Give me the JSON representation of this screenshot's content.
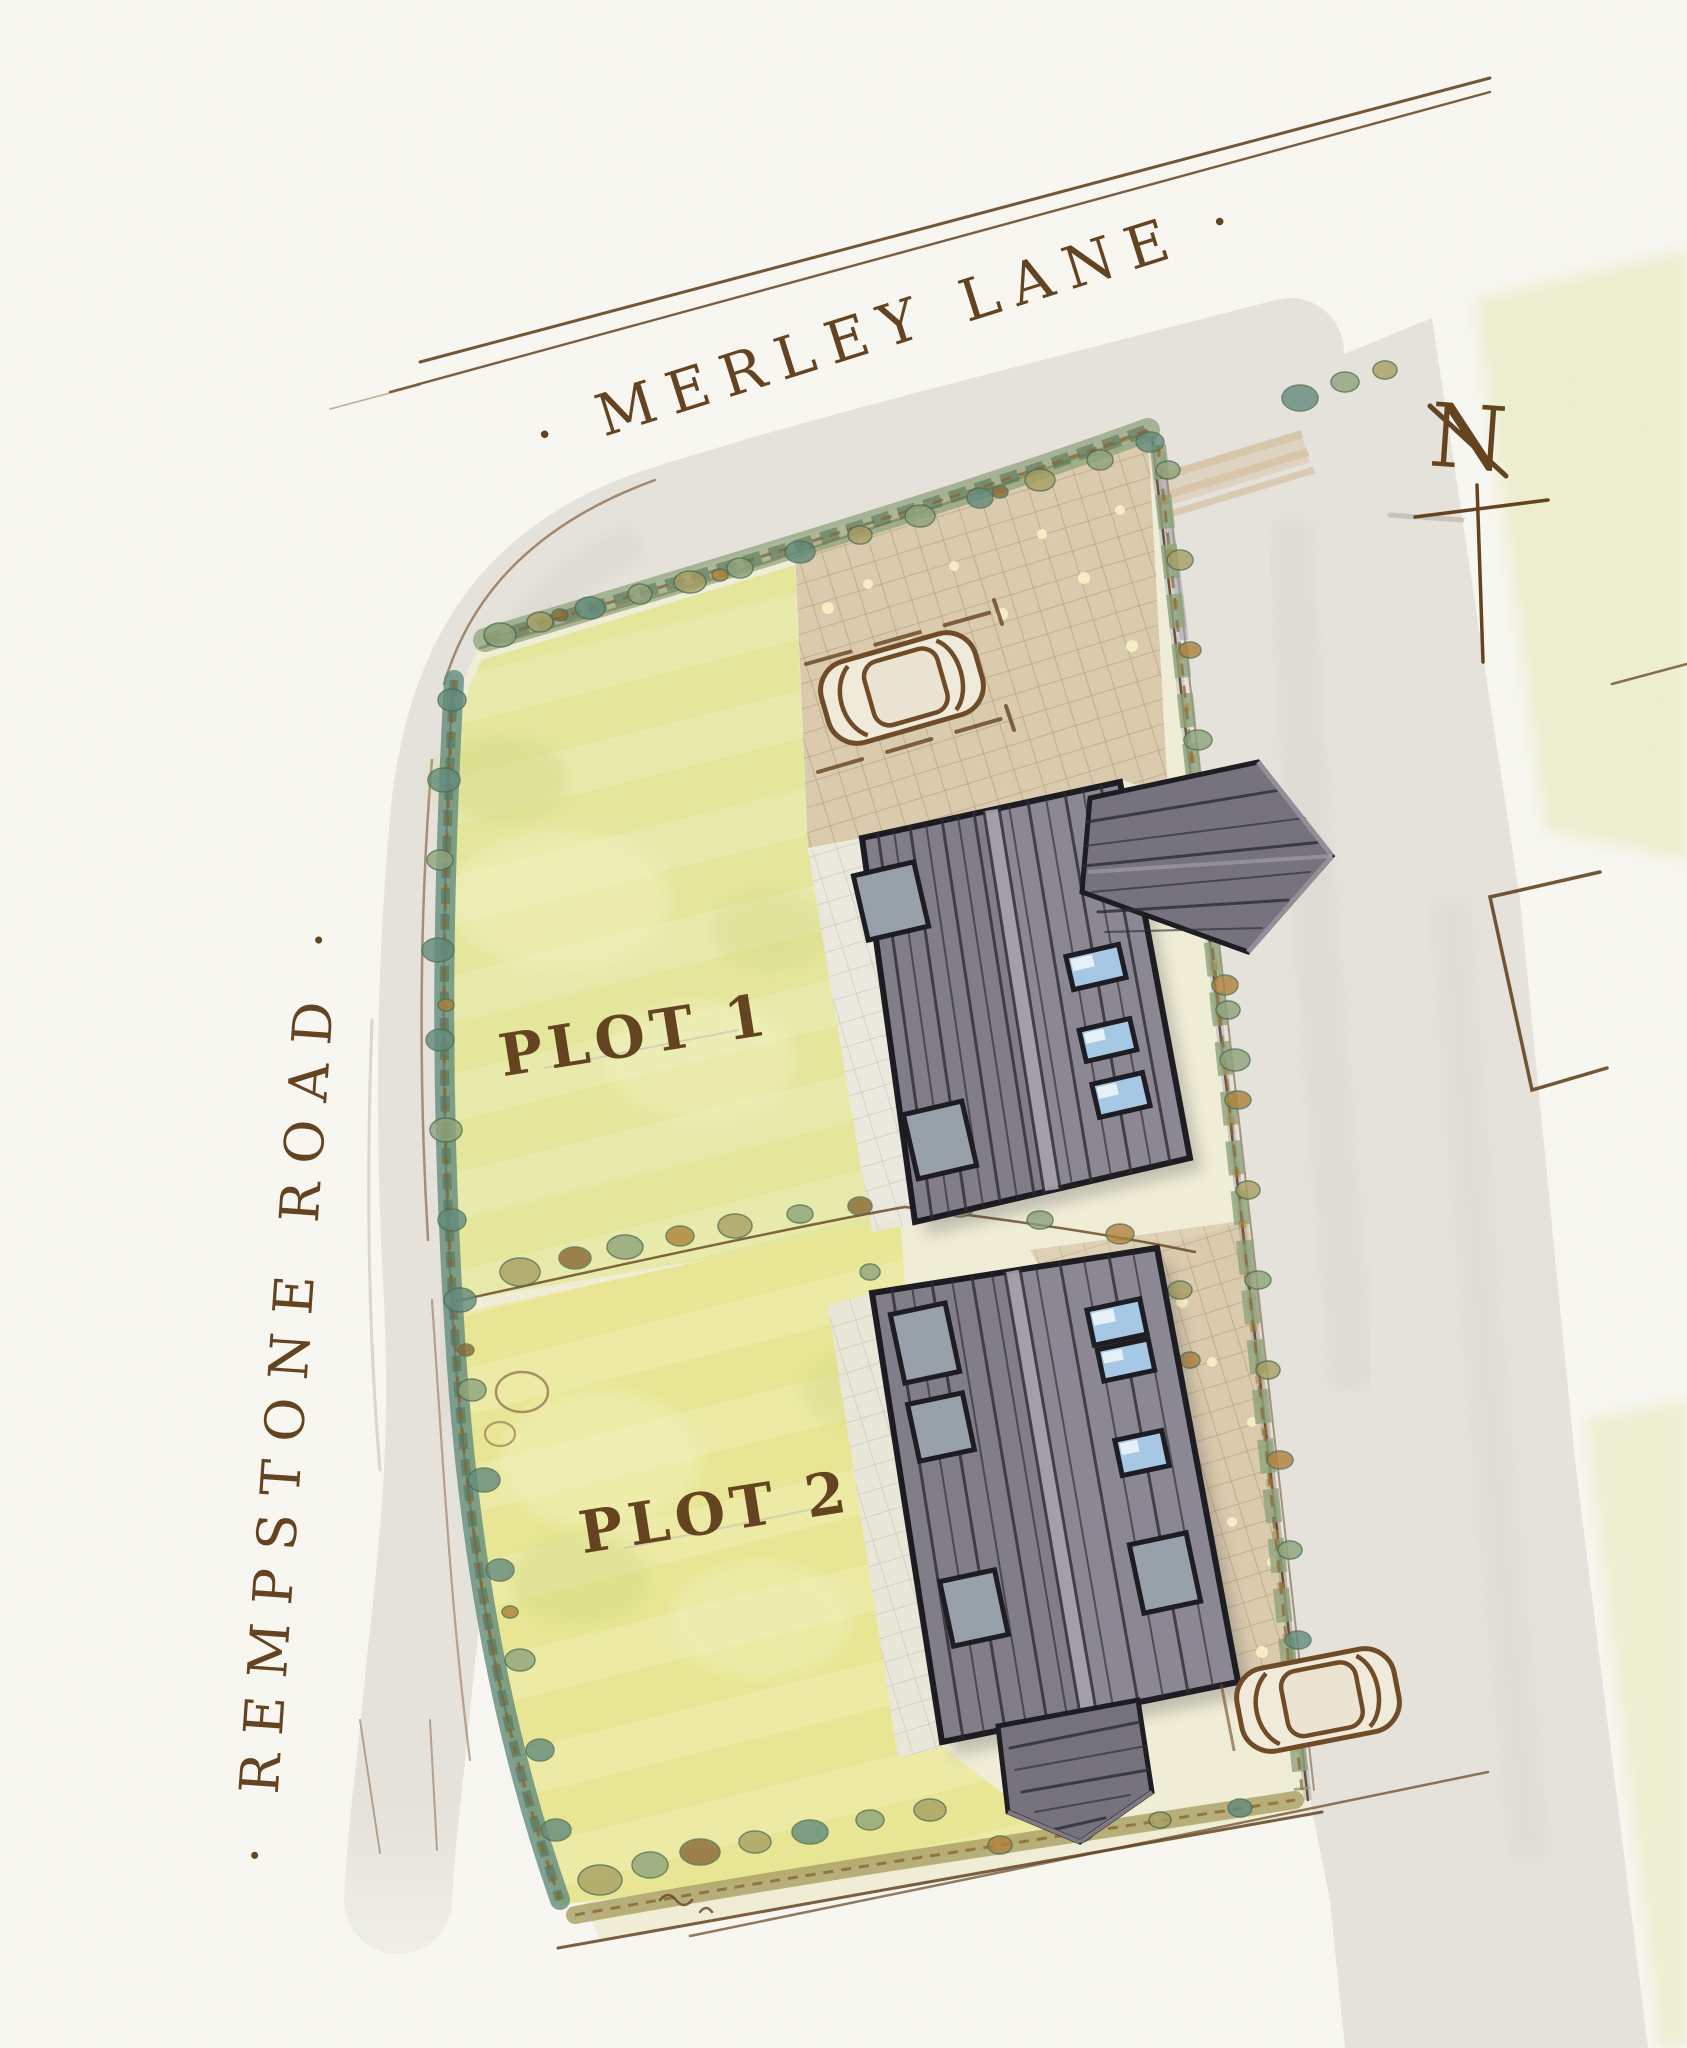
{
  "plan": {
    "streets": {
      "top": {
        "name": "· MERLEY LANE ·"
      },
      "left": {
        "name": "· REMPSTONE ROAD ·"
      }
    },
    "plots": [
      {
        "label": "PLOT 1"
      },
      {
        "label": "PLOT 2"
      }
    ],
    "compass": {
      "label": "N"
    }
  },
  "palette": {
    "paper": "#f8f7f2",
    "ink": "#63421f",
    "inkSoft": "#8a6a48",
    "pencil": "#c2bdb2",
    "road": "#e6e3dd",
    "roadWash": "#d9d6cf",
    "verge": "#eaedc4",
    "siteCream": "#f1eed7",
    "lawnA": "#e5e79c",
    "lawnB": "#e9e794",
    "lawnLight": "#f3f3bf",
    "lawnDark": "#d6dc86",
    "hedgeSage": "#8fa37b",
    "hedgeTeal": "#628b7c",
    "hedgeDark": "#4f6e52",
    "bushOlive": "#a89f63",
    "bushOrange": "#b0813a",
    "bushBrown": "#8a6633",
    "pavingTan": "#dbcbae",
    "pavingLine": "#a68e66",
    "pavingDot": "#f8f0c6",
    "pathGrey": "#eae8e1",
    "pathLine": "#b3ab9b",
    "roofMid": "#8c8893",
    "roofDark": "#76727d",
    "roofLight": "#a7a3ad",
    "roofLine": "#2d2b31",
    "roofOutline": "#1c1b21",
    "rooflightGrey": "#98a0aa",
    "skylightBlue": "#a6c8e6",
    "skylightHi": "#e7f1fa",
    "carBody": "#f1ebdc",
    "kerbShadow": "#96a0ad",
    "crossingTan": "#d9c6a8"
  }
}
